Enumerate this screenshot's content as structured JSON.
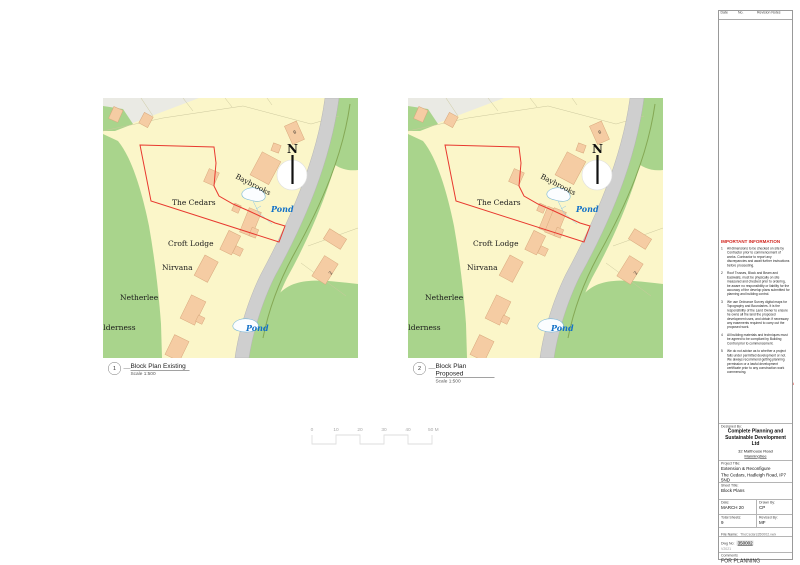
{
  "revision_table": {
    "headers": [
      "Date",
      "No.",
      "Revision Notes"
    ]
  },
  "important_information": {
    "heading": "IMPORTANT INFORMATION",
    "items": [
      {
        "n": "1",
        "text": "All dimensions to be checked on site by Contractor prior to commencement of works. Contractor to report any discrepancies and await further instructions before proceeding."
      },
      {
        "n": "2",
        "text": "Roof Trusses, Block and Beam and Easiwalls, must be physically on site measured and checked prior to ordering, be aware no responsibility or liability for the accuracy of the develop plans submitted for planning and building control."
      },
      {
        "n": "3",
        "text": "We use Ordnance Survey digital maps for Topography and Boundaries. It is the responsibility of the Land Owner to ensure he owns all the land the proposed development uses, and obtain if necessary any easements required to carry out the proposed work."
      },
      {
        "n": "4",
        "text": "All building materials and techniques must be agreed to be compliant by Building Control prior to commencement."
      },
      {
        "n": "5",
        "text": "We do not advise as to whether a project falls under permitted development or not. We always recommend getting planning permission or a lawful development certificate prior to any construction work commencing."
      }
    ]
  },
  "logo": {
    "top_text": "COMPLETE",
    "bottom_text": "PLANNING",
    "red": "#e0382d"
  },
  "title_block": {
    "designed_by_label": "Designed By:",
    "company_line1": "Complete Planning and",
    "company_line2": "Sustainable Development Ltd",
    "address_line1": "32 Malthouse Road",
    "address_line2": "Manningtree",
    "address_line3": "CO11 1BY",
    "project_label": "Project Title:",
    "project_name": "Extension & Reconfigure",
    "project_address": "The Cedars, Hadleigh Road, IP7 5ND",
    "sheet_label": "Sheet Title:",
    "sheet_name": "Block Plans",
    "date_label": "Date:",
    "date_value": "MARCH 20",
    "drawn_by_label": "Drawn By:",
    "drawn_by_value": "CP",
    "total_sheets_label": "Total Sheets:",
    "total_sheets_value": "9",
    "revised_by_label": "Revised By:",
    "revised_by_value": "MF",
    "file_name_label": "File Name:",
    "file_name_value": "TheCedars350002.vwx",
    "dwg_no_label": "Dwg No:",
    "dwg_no_value": "350002",
    "dwg_no_sub": "V2021",
    "comments_label": "Comments",
    "comments_value": "FOR PLANNING"
  },
  "captions": [
    {
      "number": "1",
      "title": "Block Plan Existing",
      "scale": "Scale 1:500"
    },
    {
      "number": "2",
      "title": "Block Plan Proposed",
      "scale": "Scale 1:500"
    }
  ],
  "scale_bar": {
    "labels": [
      "0",
      "10",
      "20",
      "30",
      "40",
      "50 M"
    ]
  },
  "map_labels": {
    "north": "N",
    "baybrooks": "Baybrooks",
    "the_cedars": "The Cedars",
    "croft_lodge": "Croft Lodge",
    "nirvana": "Nirvana",
    "netherlee": "Netherlee",
    "wilderness": "ilderness",
    "pond_upper": "Pond",
    "pond_lower": "Pond",
    "house_no_6": "6",
    "house_no_2": "2"
  },
  "map_colors": {
    "land": "#fbf6c9",
    "woodland": "#a9d48c",
    "road": "#cfcfcf",
    "building": "#f5cca3",
    "pond_stroke": "#79b7d9",
    "boundary_red": "#e8392f",
    "pond_text_blue": "#1472c8"
  }
}
